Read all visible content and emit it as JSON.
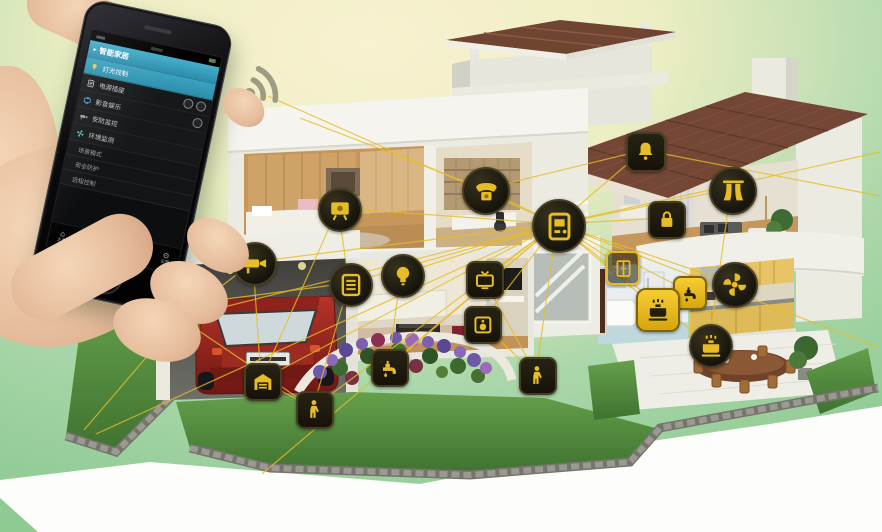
{
  "colors": {
    "accent": "#e7bd27",
    "icon_yellow": "#f0c41e",
    "teal": "#43aecb",
    "bg_cream": "#f7f2d0",
    "bg_green": "#9ccf9e",
    "grass": "#538c3c",
    "roof_brown": "#744636",
    "car_red": "#a9261e",
    "kitchen_yellow": "#e7c466",
    "skin": "#ecc7a7"
  },
  "phone": {
    "status_icons": [
      "signal",
      "notification",
      "battery"
    ],
    "header": {
      "marker": "▸",
      "label": "智能家居"
    },
    "rows": [
      {
        "icon": "bulb",
        "label": "灯光控制",
        "highlight": true,
        "buttons": []
      },
      {
        "icon": "grid",
        "label": "电源插座",
        "highlight": false,
        "buttons": [
          "switch-a",
          "switch-b"
        ]
      },
      {
        "icon": "tv",
        "label": "影音娱乐",
        "highlight": false,
        "buttons": [
          "switch-a"
        ]
      },
      {
        "icon": "camera",
        "label": "安防监控",
        "highlight": false,
        "buttons": []
      },
      {
        "icon": "fan",
        "label": "环境监测",
        "highlight": false,
        "buttons": []
      }
    ],
    "sections": [
      {
        "label": "场景模式"
      },
      {
        "label": "安全防护"
      },
      {
        "label": "远程控制"
      }
    ],
    "nav": [
      {
        "icon": "⌂",
        "label": "主页",
        "active": false
      },
      {
        "icon": "▤",
        "label": "设备",
        "active": false
      },
      {
        "icon": "◉",
        "label": "场景",
        "active": true
      },
      {
        "icon": "✉",
        "label": "消息",
        "active": false
      },
      {
        "icon": "⚙",
        "label": "设置",
        "active": false
      }
    ]
  },
  "signal_icon": "wifi-waves",
  "devices": [
    {
      "id": "bedroom-monitor",
      "glyph": "monitor",
      "shape": "circle",
      "x": 338,
      "y": 208,
      "s": 40
    },
    {
      "id": "study-phone",
      "glyph": "phone",
      "shape": "circle",
      "x": 484,
      "y": 189,
      "s": 44
    },
    {
      "id": "control-hub",
      "glyph": "panel",
      "shape": "circle",
      "x": 557,
      "y": 224,
      "s": 50
    },
    {
      "id": "alarm-bell",
      "glyph": "bell",
      "shape": "square",
      "x": 644,
      "y": 150,
      "s": 36
    },
    {
      "id": "curtain-control",
      "glyph": "curtain",
      "shape": "circle",
      "x": 731,
      "y": 189,
      "s": 44
    },
    {
      "id": "door-lock",
      "glyph": "lock",
      "shape": "square",
      "x": 665,
      "y": 218,
      "s": 34
    },
    {
      "id": "switch-panel",
      "glyph": "grid",
      "shape": "circle",
      "x": 349,
      "y": 283,
      "s": 40
    },
    {
      "id": "light-bulb",
      "glyph": "bulb",
      "shape": "circle",
      "x": 401,
      "y": 274,
      "s": 40
    },
    {
      "id": "tv-control",
      "glyph": "tv",
      "shape": "square",
      "x": 483,
      "y": 278,
      "s": 34
    },
    {
      "id": "media-panel",
      "glyph": "speaker",
      "shape": "square",
      "x": 481,
      "y": 323,
      "s": 34
    },
    {
      "id": "irrigation",
      "glyph": "faucet",
      "shape": "square",
      "x": 388,
      "y": 366,
      "s": 34
    },
    {
      "id": "garden-sprinkler",
      "glyph": "person",
      "shape": "square",
      "x": 536,
      "y": 374,
      "s": 34
    },
    {
      "id": "motion-sensor",
      "glyph": "person",
      "shape": "square",
      "x": 313,
      "y": 408,
      "s": 34
    },
    {
      "id": "cctv-camera",
      "glyph": "camera",
      "shape": "circle",
      "x": 253,
      "y": 262,
      "s": 40
    },
    {
      "id": "power-plug",
      "glyph": "plug",
      "shape": "yellow",
      "x": 180,
      "y": 318,
      "s": 32
    },
    {
      "id": "garage-door",
      "glyph": "garage",
      "shape": "square",
      "x": 261,
      "y": 380,
      "s": 34
    },
    {
      "id": "door-sensor",
      "glyph": "door",
      "shape": "outline",
      "x": 621,
      "y": 266,
      "s": 30
    },
    {
      "id": "exhaust-fan",
      "glyph": "fan",
      "shape": "circle",
      "x": 733,
      "y": 283,
      "s": 42
    },
    {
      "id": "water-faucet",
      "glyph": "faucet",
      "shape": "yellow",
      "x": 688,
      "y": 291,
      "s": 30
    },
    {
      "id": "gas-stove",
      "glyph": "pot",
      "shape": "yellow",
      "x": 656,
      "y": 308,
      "s": 40
    },
    {
      "id": "stove-monitor",
      "glyph": "pot",
      "shape": "circle",
      "x": 709,
      "y": 344,
      "s": 40
    }
  ],
  "connections": [
    [
      "control-hub",
      "bedroom-monitor"
    ],
    [
      "control-hub",
      "study-phone"
    ],
    [
      "control-hub",
      "alarm-bell"
    ],
    [
      "control-hub",
      "curtain-control"
    ],
    [
      "control-hub",
      "door-lock"
    ],
    [
      "control-hub",
      "switch-panel"
    ],
    [
      "control-hub",
      "light-bulb"
    ],
    [
      "control-hub",
      "tv-control"
    ],
    [
      "control-hub",
      "media-panel"
    ],
    [
      "control-hub",
      "irrigation"
    ],
    [
      "control-hub",
      "garden-sprinkler"
    ],
    [
      "control-hub",
      "motion-sensor"
    ],
    [
      "control-hub",
      "cctv-camera"
    ],
    [
      "control-hub",
      "power-plug"
    ],
    [
      "control-hub",
      "garage-door"
    ],
    [
      "control-hub",
      "door-sensor"
    ],
    [
      "control-hub",
      "exhaust-fan"
    ],
    [
      "control-hub",
      "water-faucet"
    ],
    [
      "control-hub",
      "gas-stove"
    ],
    [
      "control-hub",
      "stove-monitor"
    ],
    [
      "cctv-camera",
      "power-plug"
    ],
    [
      "cctv-camera",
      "garage-door"
    ],
    [
      "bedroom-monitor",
      "garage-door"
    ],
    [
      "power-plug",
      "motion-sensor"
    ],
    [
      "light-bulb",
      "irrigation"
    ],
    [
      "tv-control",
      "garden-sprinkler"
    ],
    [
      "study-phone",
      "alarm-bell"
    ],
    [
      "curtain-control",
      "stove-monitor"
    ],
    [
      "switch-panel",
      "motion-sensor"
    ],
    [
      "garage-door",
      "motion-sensor"
    ],
    [
      "bedroom-monitor",
      "switch-panel"
    ],
    [
      "media-panel",
      "garden-sprinkler"
    ]
  ],
  "rays": [
    [
      557,
      224,
      880,
      152
    ],
    [
      557,
      224,
      880,
      348
    ],
    [
      644,
      150,
      880,
      196
    ],
    [
      557,
      224,
      96,
      434
    ],
    [
      484,
      189,
      300,
      118
    ],
    [
      557,
      224,
      262,
      474
    ],
    [
      349,
      283,
      80,
      318
    ],
    [
      180,
      318,
      84,
      430
    ],
    [
      557,
      224,
      268,
      96
    ]
  ]
}
